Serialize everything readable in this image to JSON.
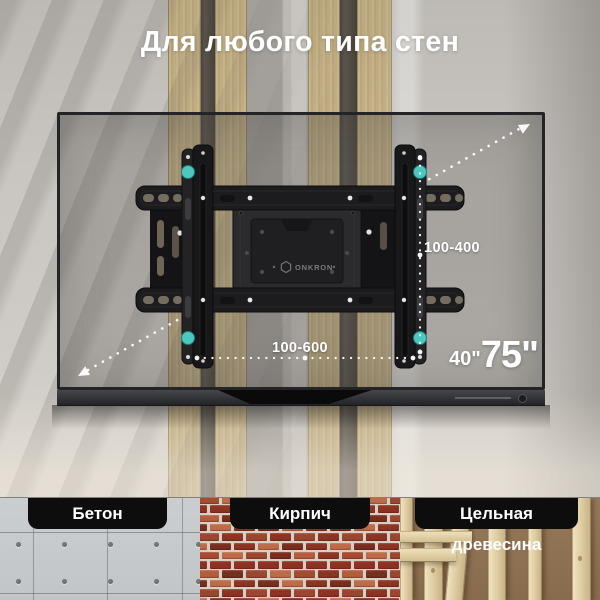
{
  "title": "Для любого типа стен",
  "brand": "ONKRON",
  "tv": {
    "diagonal_min": "40\"",
    "diagonal_max": "75\""
  },
  "vesa": {
    "vertical_range": "100-400",
    "horizontal_range": "100-600"
  },
  "materials": [
    {
      "id": "concrete",
      "label": "Бетон"
    },
    {
      "id": "brick",
      "label": "Кирпич"
    },
    {
      "id": "solid-wood",
      "label": "Цельная древесина"
    }
  ],
  "colors": {
    "accent_teal": "#4CC8C0",
    "chip_background": "#0D0D0D",
    "label_text": "#FFFFFF"
  },
  "icons": {
    "diagonal_arrow": "double-headed-dotted-arrow",
    "logo_mark": "hexagon-outline"
  }
}
